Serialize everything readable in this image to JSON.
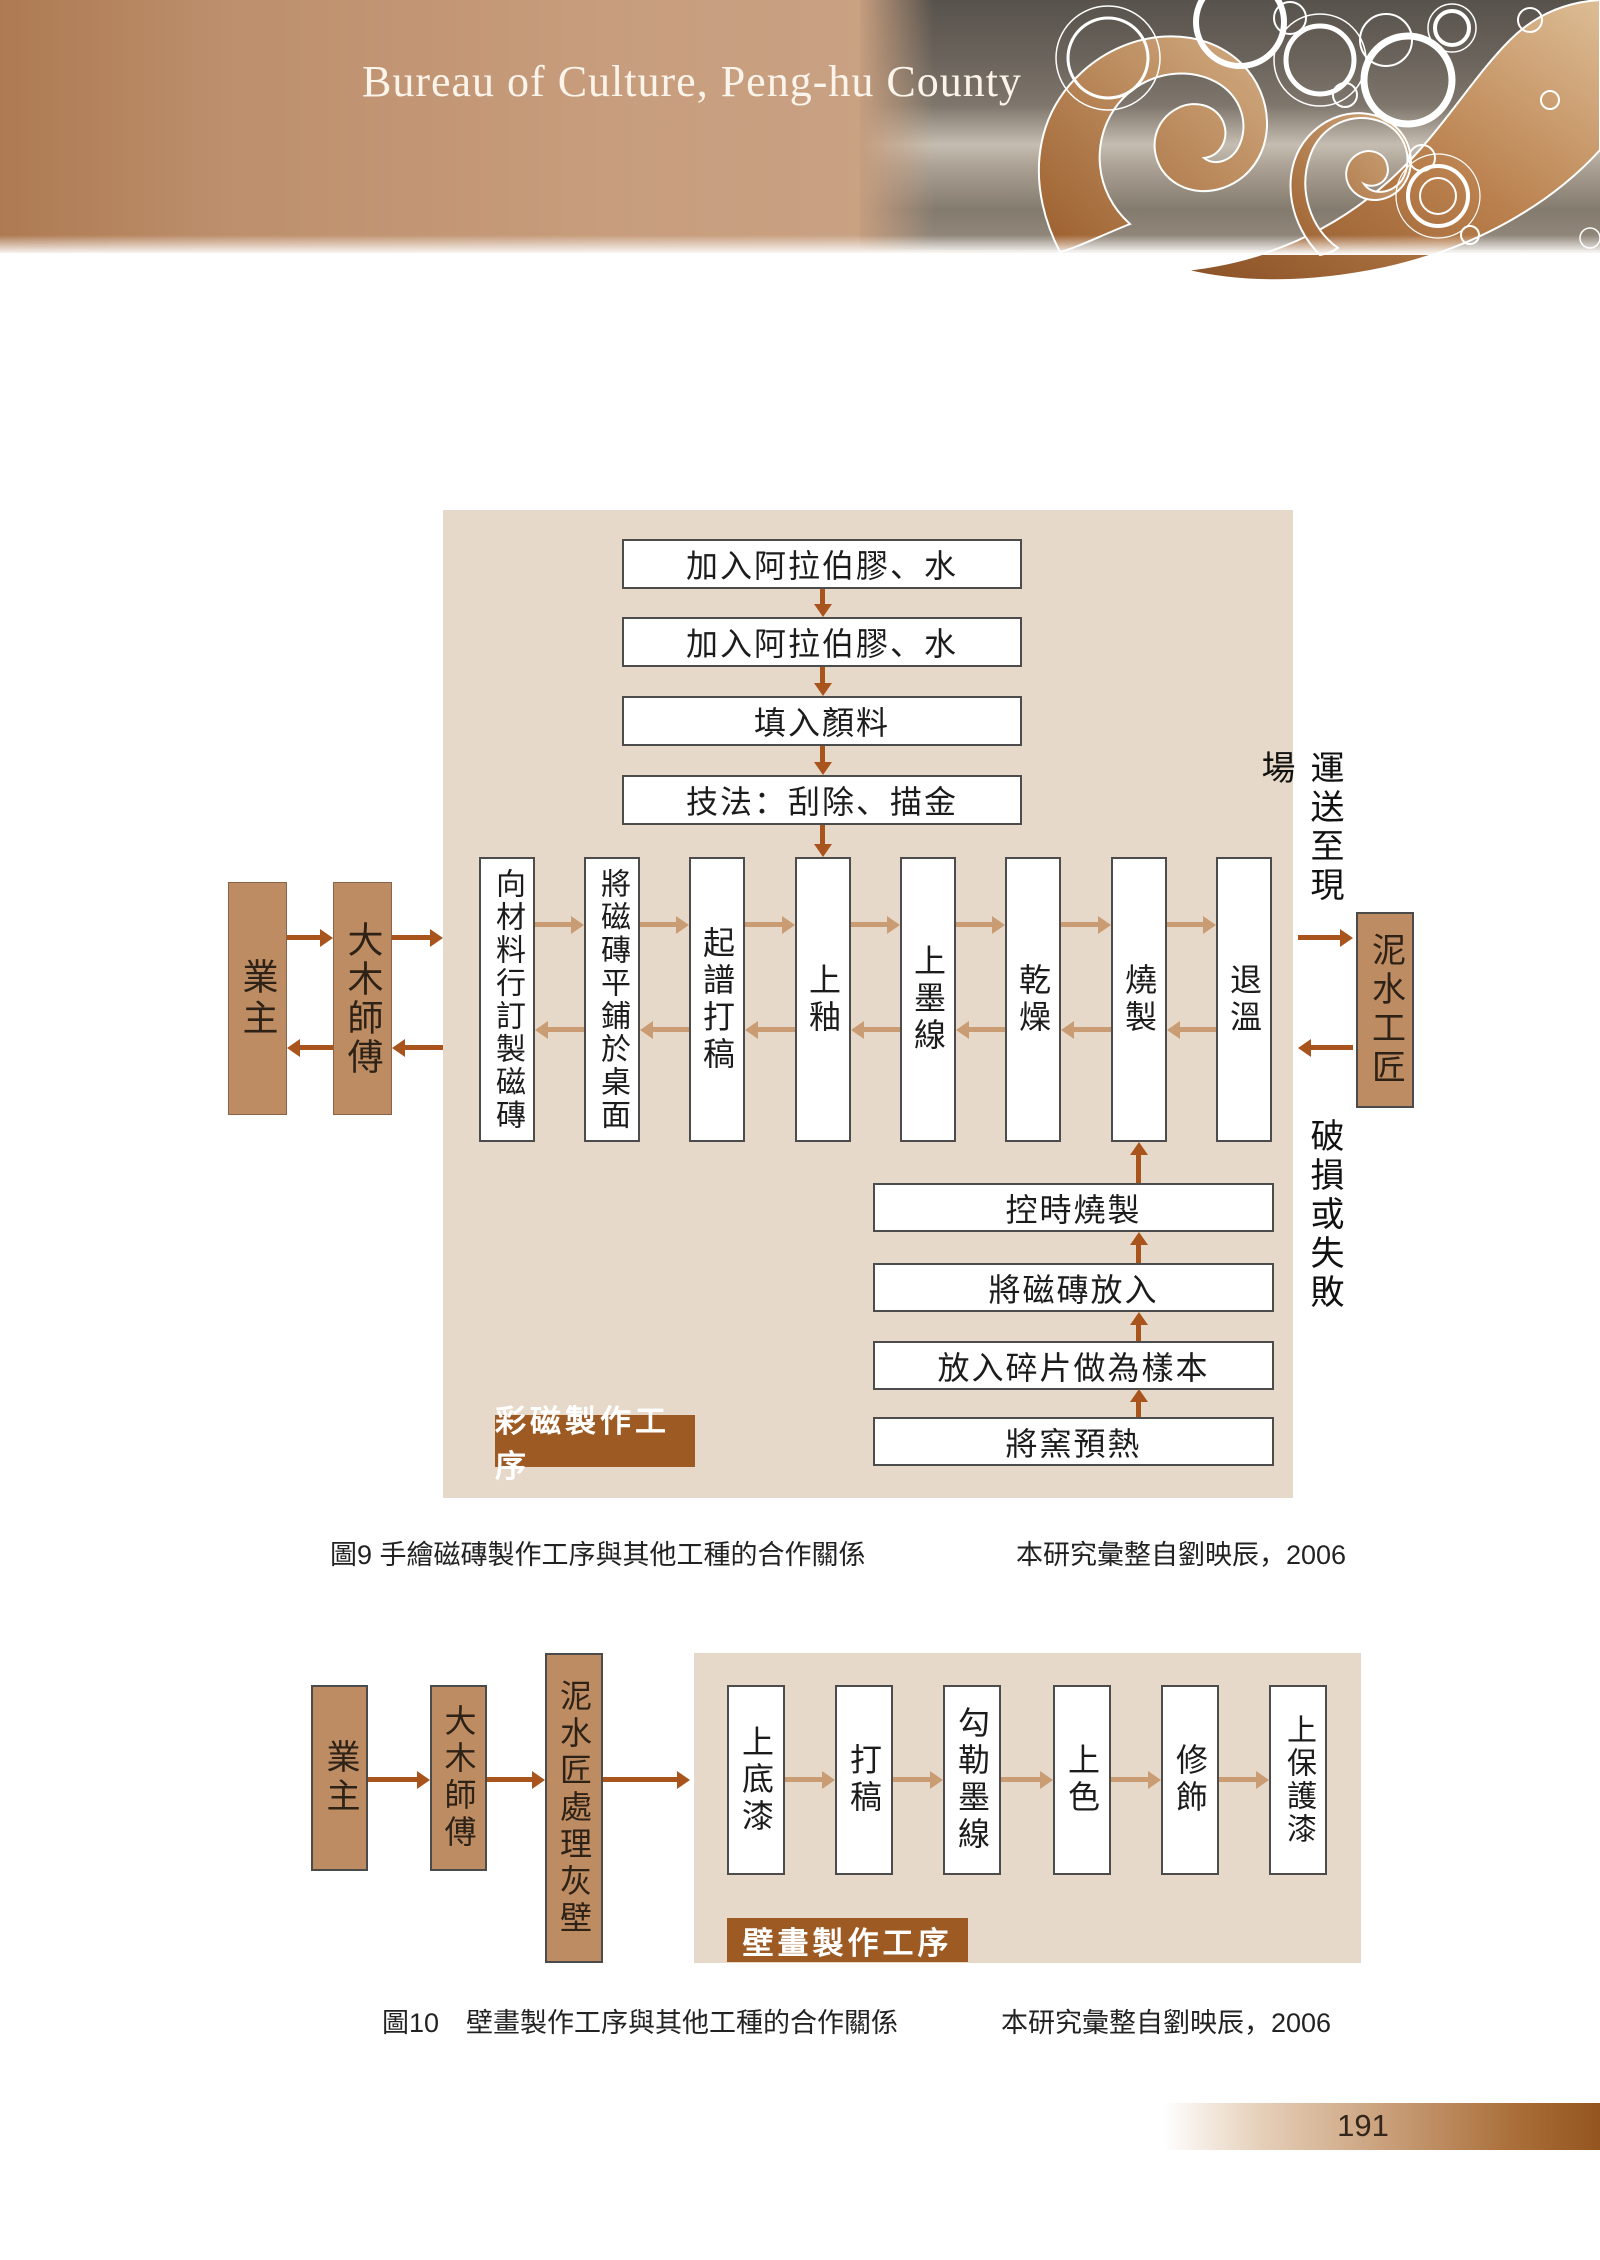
{
  "header": {
    "title": "Bureau of Culture, Peng-hu County"
  },
  "chart1": {
    "label": "彩磁製作工序",
    "top_steps": [
      "加入阿拉伯膠、水",
      "加入阿拉伯膠、水",
      "填入顏料",
      "技法：刮除、描金"
    ],
    "main_steps": [
      "向材料行訂製磁磚",
      "將磁磚平鋪於桌面",
      "起譜打稿",
      "上釉",
      "上墨線",
      "乾燥",
      "燒製",
      "退溫"
    ],
    "left_actors": [
      "業主",
      "大木師傅"
    ],
    "right_actor": "泥水工匠",
    "note_to_site": "運送至現場",
    "note_failure": "破損或失敗",
    "kiln_steps": [
      "控時燒製",
      "將磁磚放入",
      "放入碎片做為樣本",
      "將窯預熱"
    ],
    "caption": "圖9 手繪磁磚製作工序與其他工種的合作關係",
    "source": "本研究彙整自劉映辰，2006"
  },
  "chart2": {
    "label": "壁畫製作工序",
    "actors": [
      "業主",
      "大木師傅",
      "泥水匠處理灰壁"
    ],
    "steps": [
      "上底漆",
      "打稿",
      "勾勒墨線",
      "上色",
      "修飾",
      "上保護漆"
    ],
    "caption": "圖10　壁畫製作工序與其他工種的合作關係",
    "source": "本研究彙整自劉映辰，2006"
  },
  "footer": {
    "page_number": "191"
  },
  "colors": {
    "panel": "#e7d9ca",
    "arrow_dark": "#a8541c",
    "arrow_light": "#c99c74",
    "actor_box": "#bd8c63",
    "label_bg": "#9d5a23"
  }
}
